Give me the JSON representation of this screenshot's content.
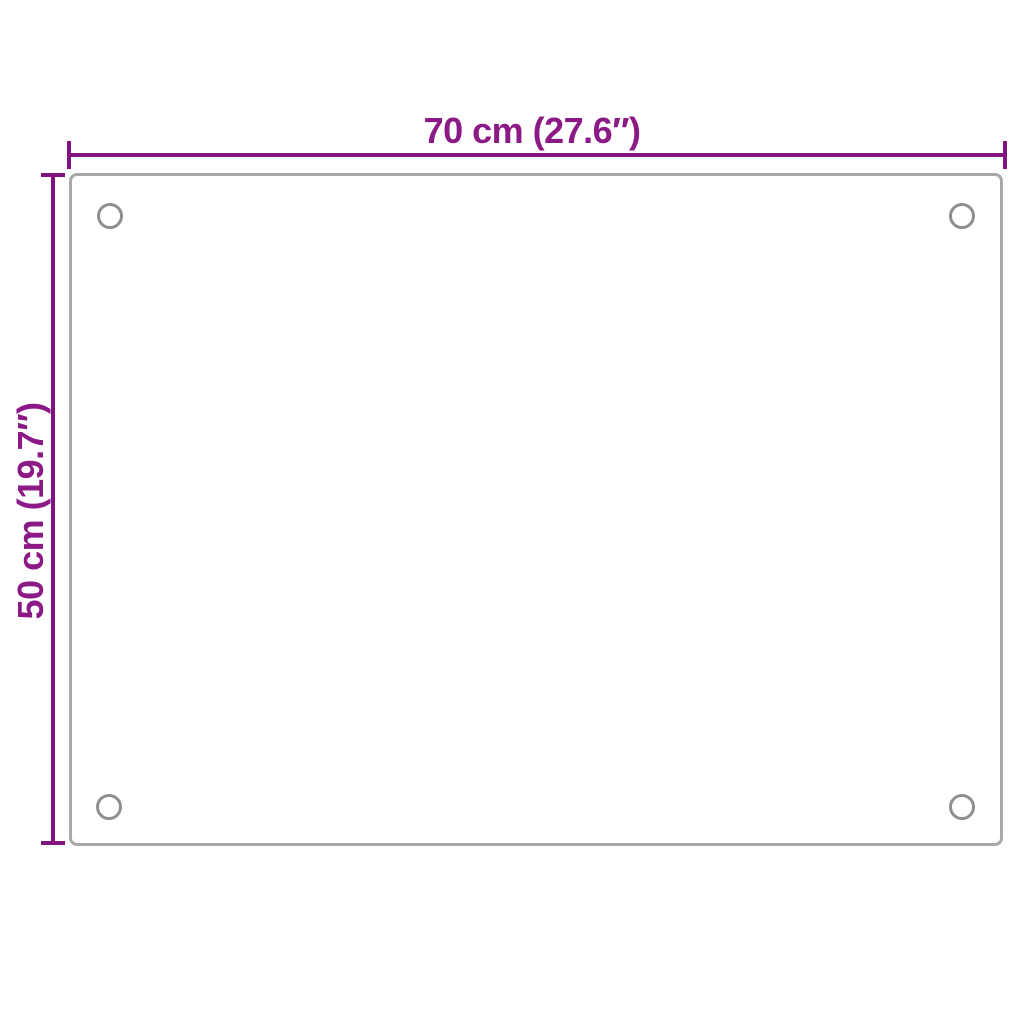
{
  "dimensions": {
    "width": {
      "label": "70 cm (27.6″)",
      "cm": 70,
      "inches": 27.6
    },
    "height": {
      "label": "50 cm (19.7″)",
      "cm": 50,
      "inches": 19.7
    }
  },
  "panel": {
    "mounting_hole_count": 4
  },
  "colors": {
    "dimension_line": "#82127E",
    "dimension_label_text": "#8B1A87",
    "panel_outline": "#A8A8A8",
    "hole_outline": "#8F8F8F",
    "background": "#FFFFFF"
  }
}
